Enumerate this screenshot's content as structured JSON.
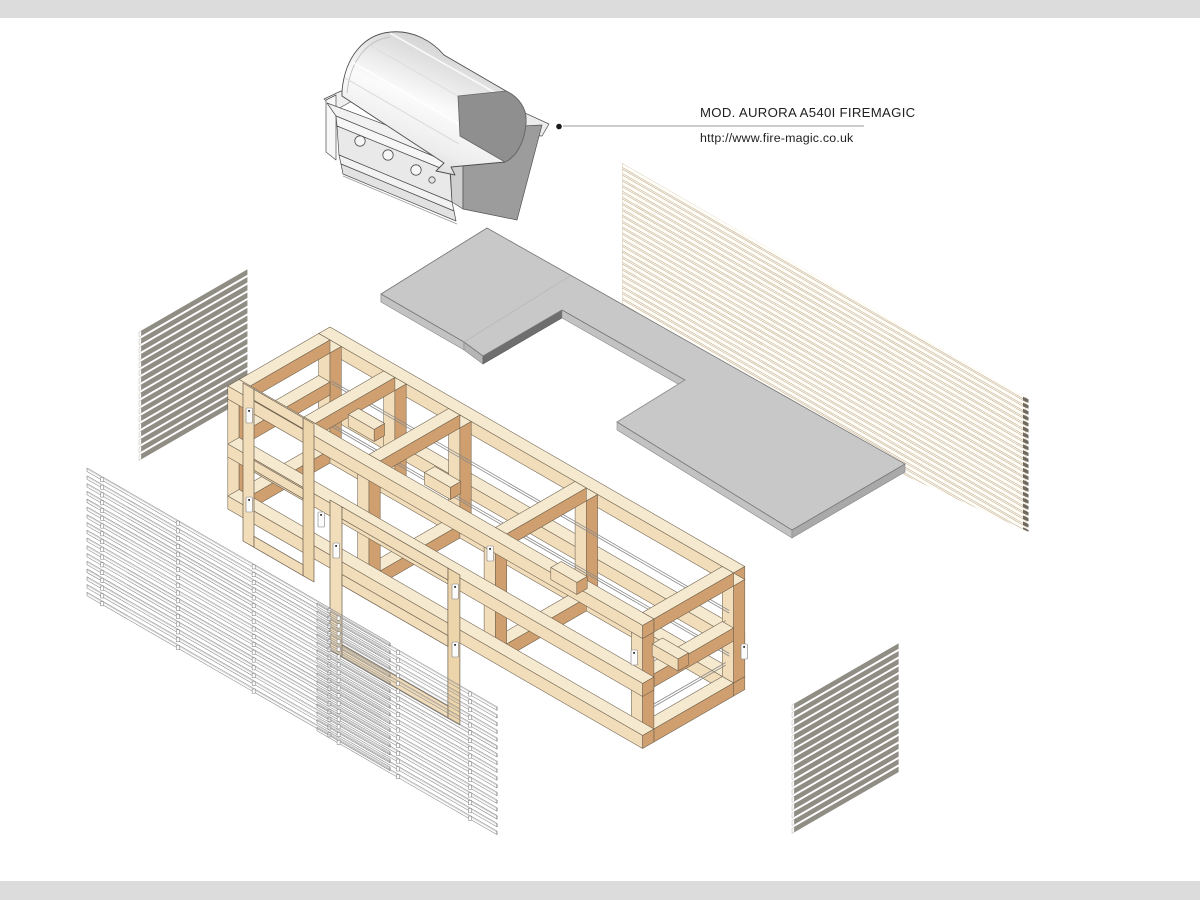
{
  "annotation": {
    "model_label": "MOD. AURORA A540I FIREMAGIC",
    "url_label": "http://www.fire-magic.co.uk"
  },
  "colors": {
    "bg": "#ffffff",
    "margin_strip": "#dcdcdc",
    "text": "#1f1f1f",
    "leader": "#9a9a9a",
    "timber_top": "#f5e9cf",
    "timber_front": "#f2ddbb",
    "timber_dark": "#cf9f6f",
    "timber_outline": "#6b5f4d",
    "slat_gray": "#908d84",
    "slat_cap": "#fbfaf7",
    "counter_top": "#c8c8c8",
    "counter_front": "#bfbfbf",
    "counter_side": "#a9a9a9",
    "counter_back_edge": "#e8e8e8",
    "counter_notch": "#6e6e6e",
    "counter_outline": "#777777",
    "wire_stroke": "#8f8f8f",
    "backpanel_fill": "#fffdf8",
    "backpanel_stroke": "#c6b291",
    "backpanel_cap": "#6f6a5f",
    "grill_light": "#f6f6f6",
    "grill_mid": "#e9e9e9",
    "grill_dark": "#8f8f8f",
    "grill_firebox": "#9c9c9c",
    "grill_outline": "#4f4f4f"
  }
}
